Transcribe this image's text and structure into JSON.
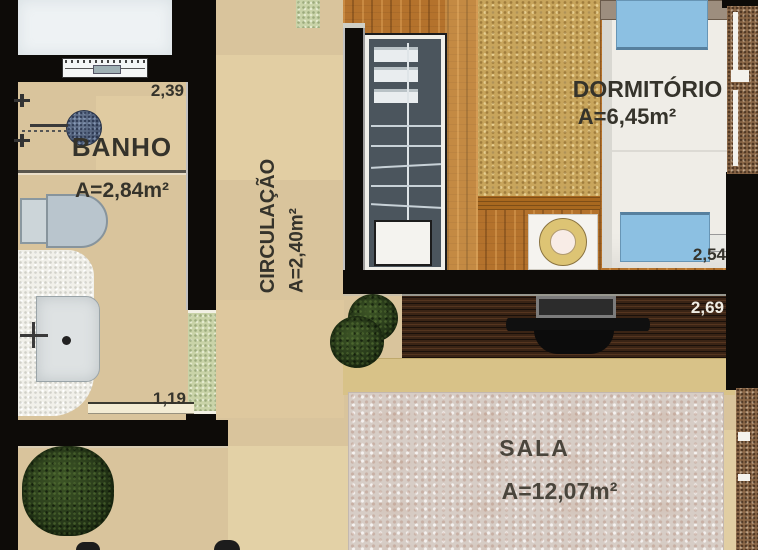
{
  "plan": {
    "rooms": [
      {
        "name": "BANHO",
        "area": "A=2,84m²"
      },
      {
        "name": "CIRCULAÇÃO",
        "area": "A=2,40m²"
      },
      {
        "name": "DORMITÓRIO",
        "area": "A=6,45m²"
      },
      {
        "name": "SALA",
        "area": "A=12,07m²"
      }
    ],
    "dimensions": {
      "banho_width": "2,39",
      "dormitorio_width": "2,54",
      "sala_wall": "2,69",
      "banho_door": "1,19"
    },
    "furniture_icons": [
      "wardrobe-icon",
      "bed-icon",
      "pillow-icon",
      "bedside-table-icon",
      "tv-stand-icon",
      "tv-icon",
      "shower-icon",
      "tap-icon",
      "toilet-icon",
      "washbasin-icon",
      "plant-icon",
      "window-icon",
      "door-opening-icon"
    ],
    "colors": {
      "wall": "#0d0b08",
      "floor": "#d9c49c",
      "wood_floor": "#b4722c",
      "dorm_rug": "#c8a55c",
      "sala_rug": "#d7cdc6",
      "pillow_blue": "#8cc0e2",
      "label_dark": "#35332b",
      "label_light": "#f0ede4"
    }
  }
}
